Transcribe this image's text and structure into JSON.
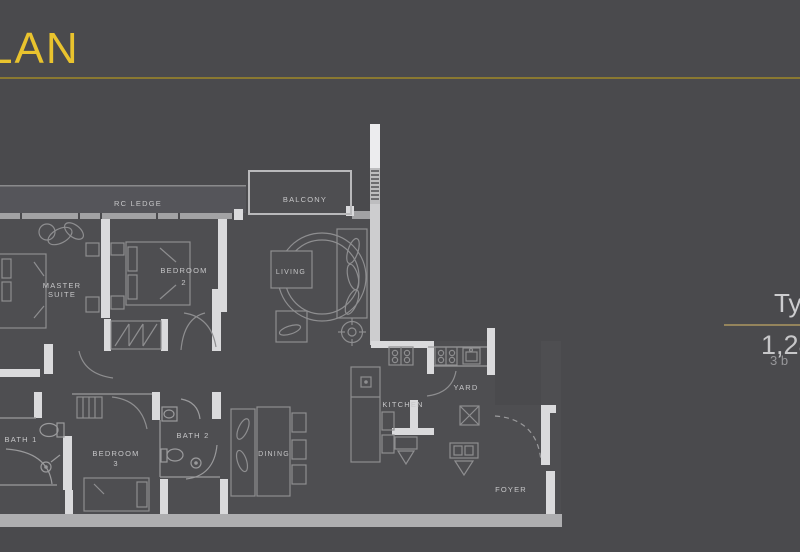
{
  "header": {
    "title": "LAN"
  },
  "info_panel": {
    "type_label": "Typ",
    "area_label": "1,28",
    "bedrooms_label": "3 b"
  },
  "colors": {
    "background": "#4a4a4d",
    "accent_gold": "#e9c32e",
    "title_underline_gold": "#8a7931",
    "panel_rule_tan": "#94845c",
    "wall_light": "#dadadc",
    "wall_muted": "#a2a2a4",
    "furniture_line": "#8e8e90",
    "label_text": "#c6c6c8",
    "panel_text": "#c7c7c9"
  },
  "floor_plan": {
    "rooms": {
      "rc_ledge": "RC LEDGE",
      "balcony": "BALCONY",
      "master_suite_line1": "MASTER",
      "master_suite_line2": "SUITE",
      "bedroom2_line1": "BEDROOM",
      "bedroom2_line2": "2",
      "living": "LIVING",
      "bath1": "BATH 1",
      "bedroom3_line1": "BEDROOM",
      "bedroom3_line2": "3",
      "bath2": "BATH 2",
      "dining": "DINING",
      "kitchen": "KITCHEN",
      "yard": "YARD",
      "foyer": "FOYER"
    }
  }
}
